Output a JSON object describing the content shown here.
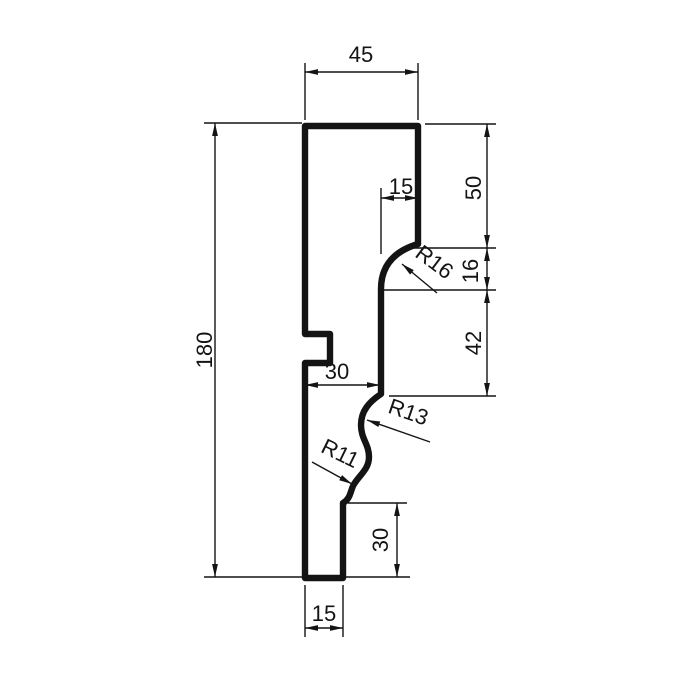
{
  "drawing": {
    "kind": "moulding-profile-cross-section",
    "colors": {
      "ink": "#141414",
      "background": "#ffffff"
    },
    "dims": {
      "top_width": "45",
      "overall_height": "180",
      "upper_face_height": "50",
      "step_width": "15",
      "corner_radius": "R16",
      "corner_height": "16",
      "mid_face_height": "42",
      "mid_depth": "30",
      "cove_radius": "R13",
      "bead_radius": "R11",
      "bottom_face_height": "30",
      "bottom_width": "15"
    }
  }
}
